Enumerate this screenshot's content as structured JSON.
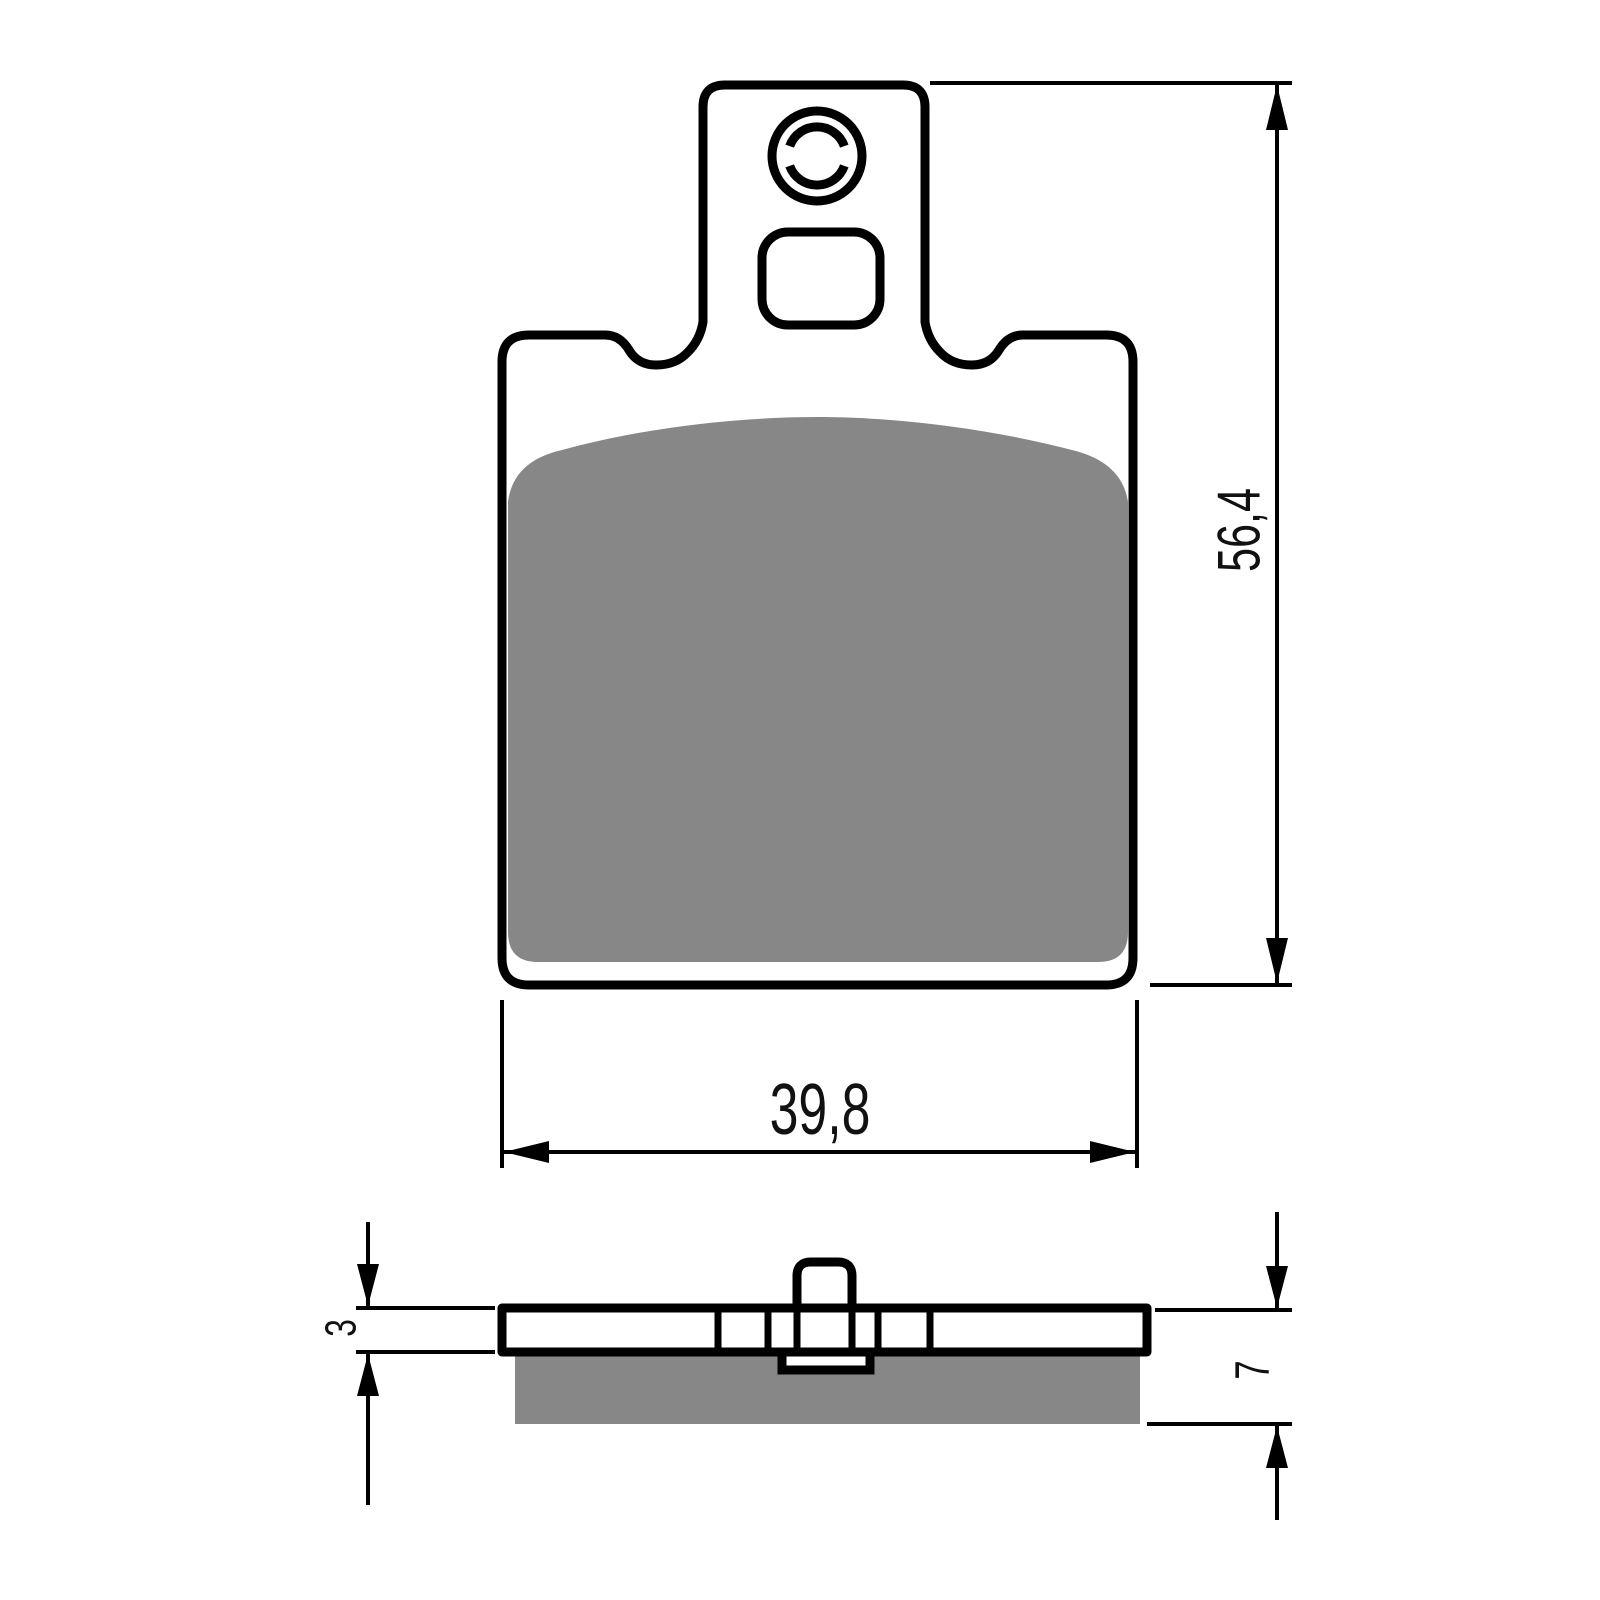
{
  "drawing": {
    "background_color": "#ffffff",
    "line_color": "#000000",
    "friction_material_color": "#878787",
    "labels": {
      "height": "56,4",
      "width": "39,8",
      "backing_plate_thickness": "3",
      "total_thickness": "7"
    }
  }
}
